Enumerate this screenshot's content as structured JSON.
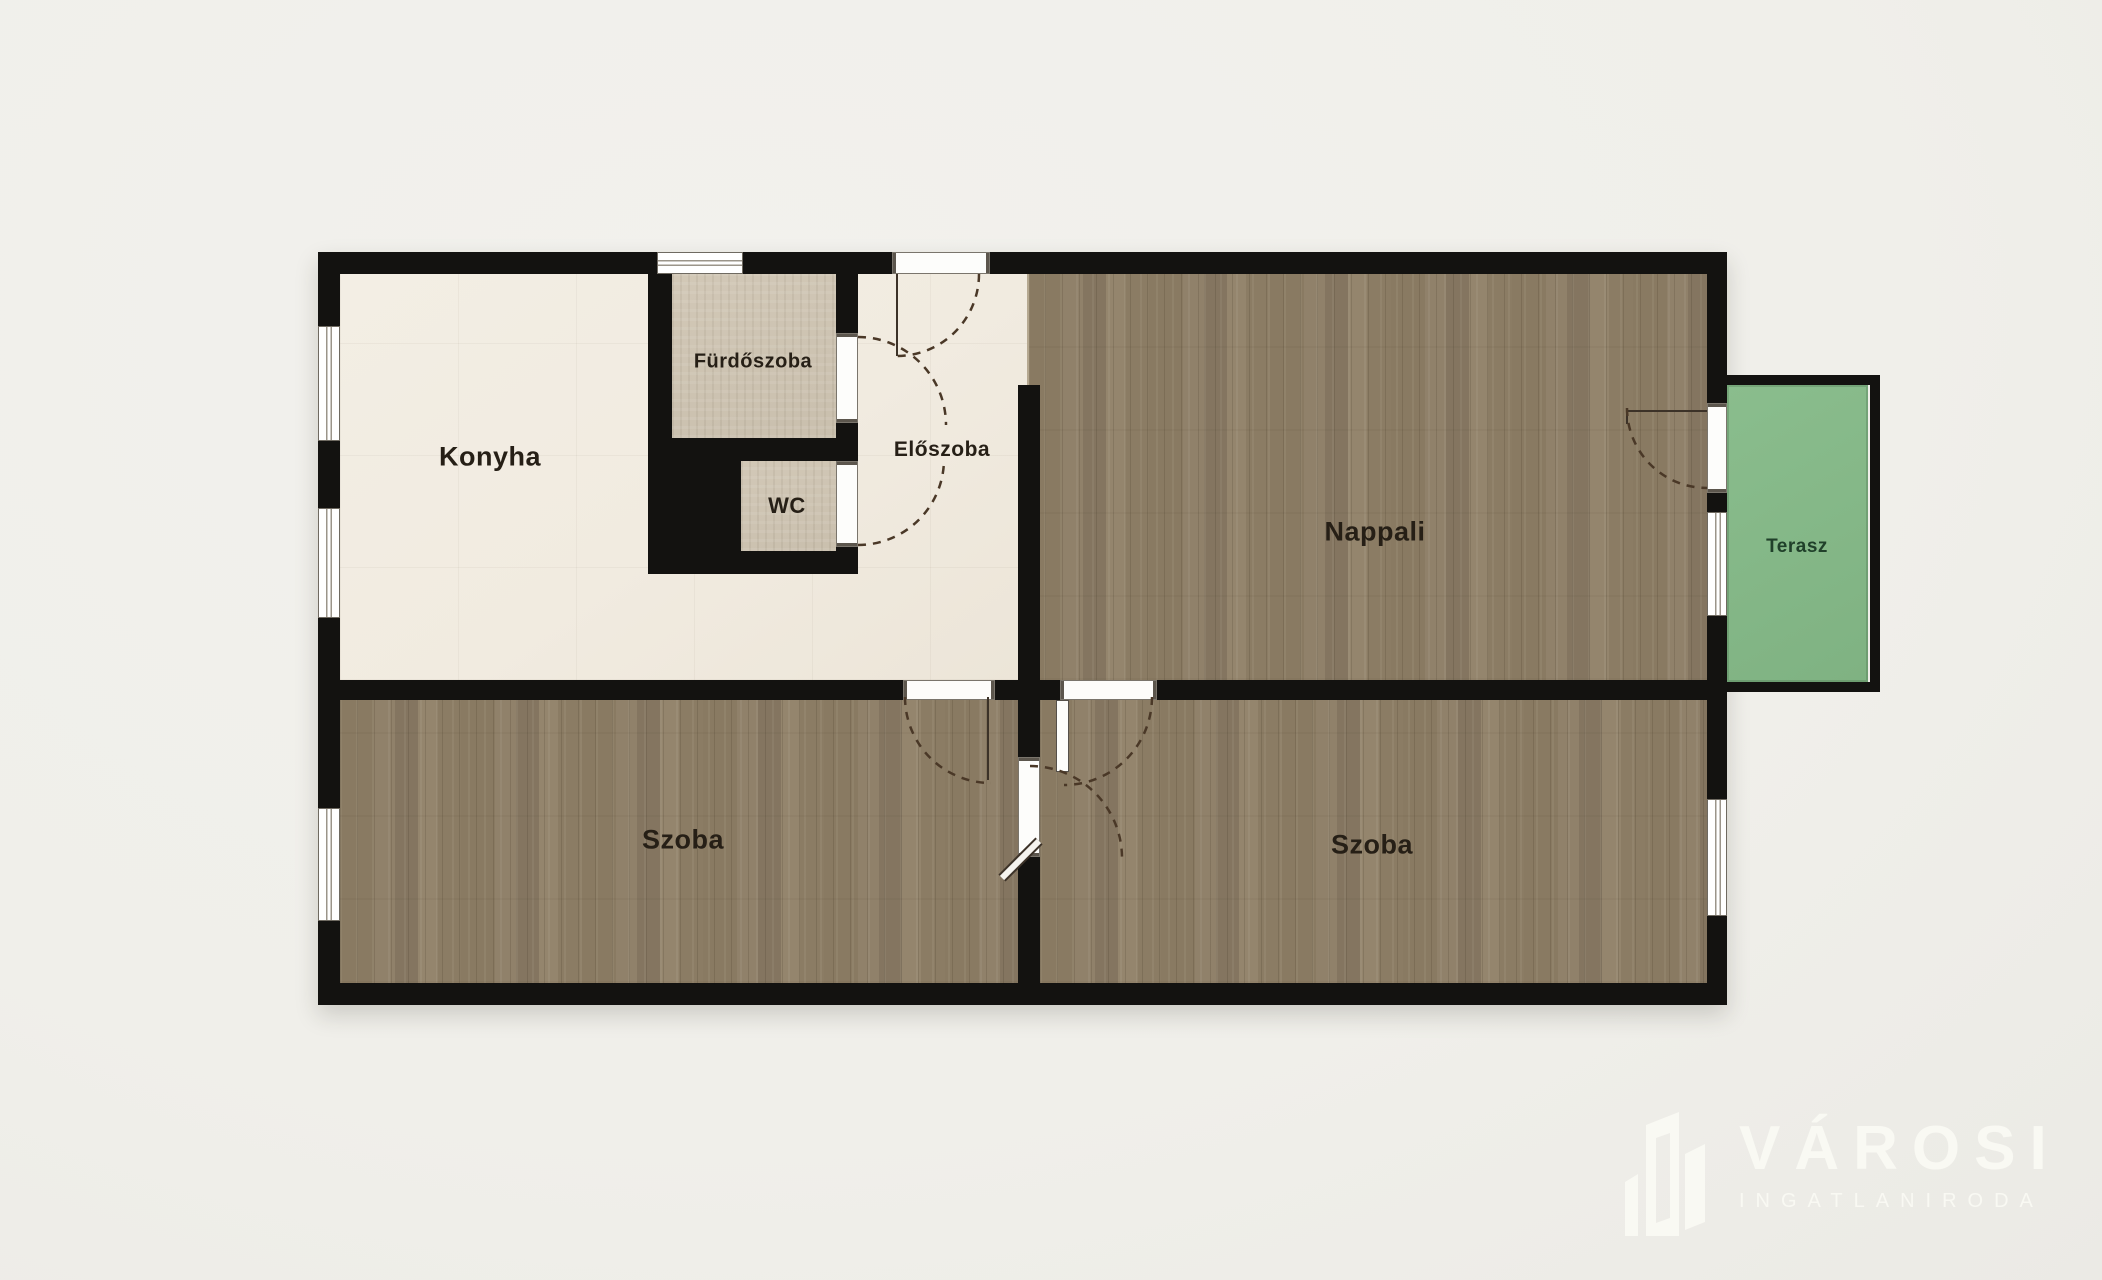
{
  "plan": {
    "rooms": [
      {
        "id": "konyha",
        "label": "Konyha"
      },
      {
        "id": "furdoszoba",
        "label": "Fürdőszoba"
      },
      {
        "id": "wc",
        "label": "WC"
      },
      {
        "id": "eloszoba",
        "label": "Előszoba"
      },
      {
        "id": "nappali",
        "label": "Nappali"
      },
      {
        "id": "terasz",
        "label": "Terasz"
      },
      {
        "id": "szoba_bal",
        "label": "Szoba"
      },
      {
        "id": "szoba_jobb",
        "label": "Szoba"
      }
    ]
  },
  "logo": {
    "brand": "VÁROSI",
    "subtitle": "INGATLANIRODA"
  },
  "colors": {
    "wall": "#131210",
    "cream": "#f1ebe0",
    "wood": "#8d7e66",
    "tile": "#cdc3b1",
    "green": "#85b888",
    "green-label": "#20402a",
    "label": "#261f16",
    "logo": "#f9f9f3",
    "bg": "#f0efea",
    "dash": "#4a3827"
  }
}
